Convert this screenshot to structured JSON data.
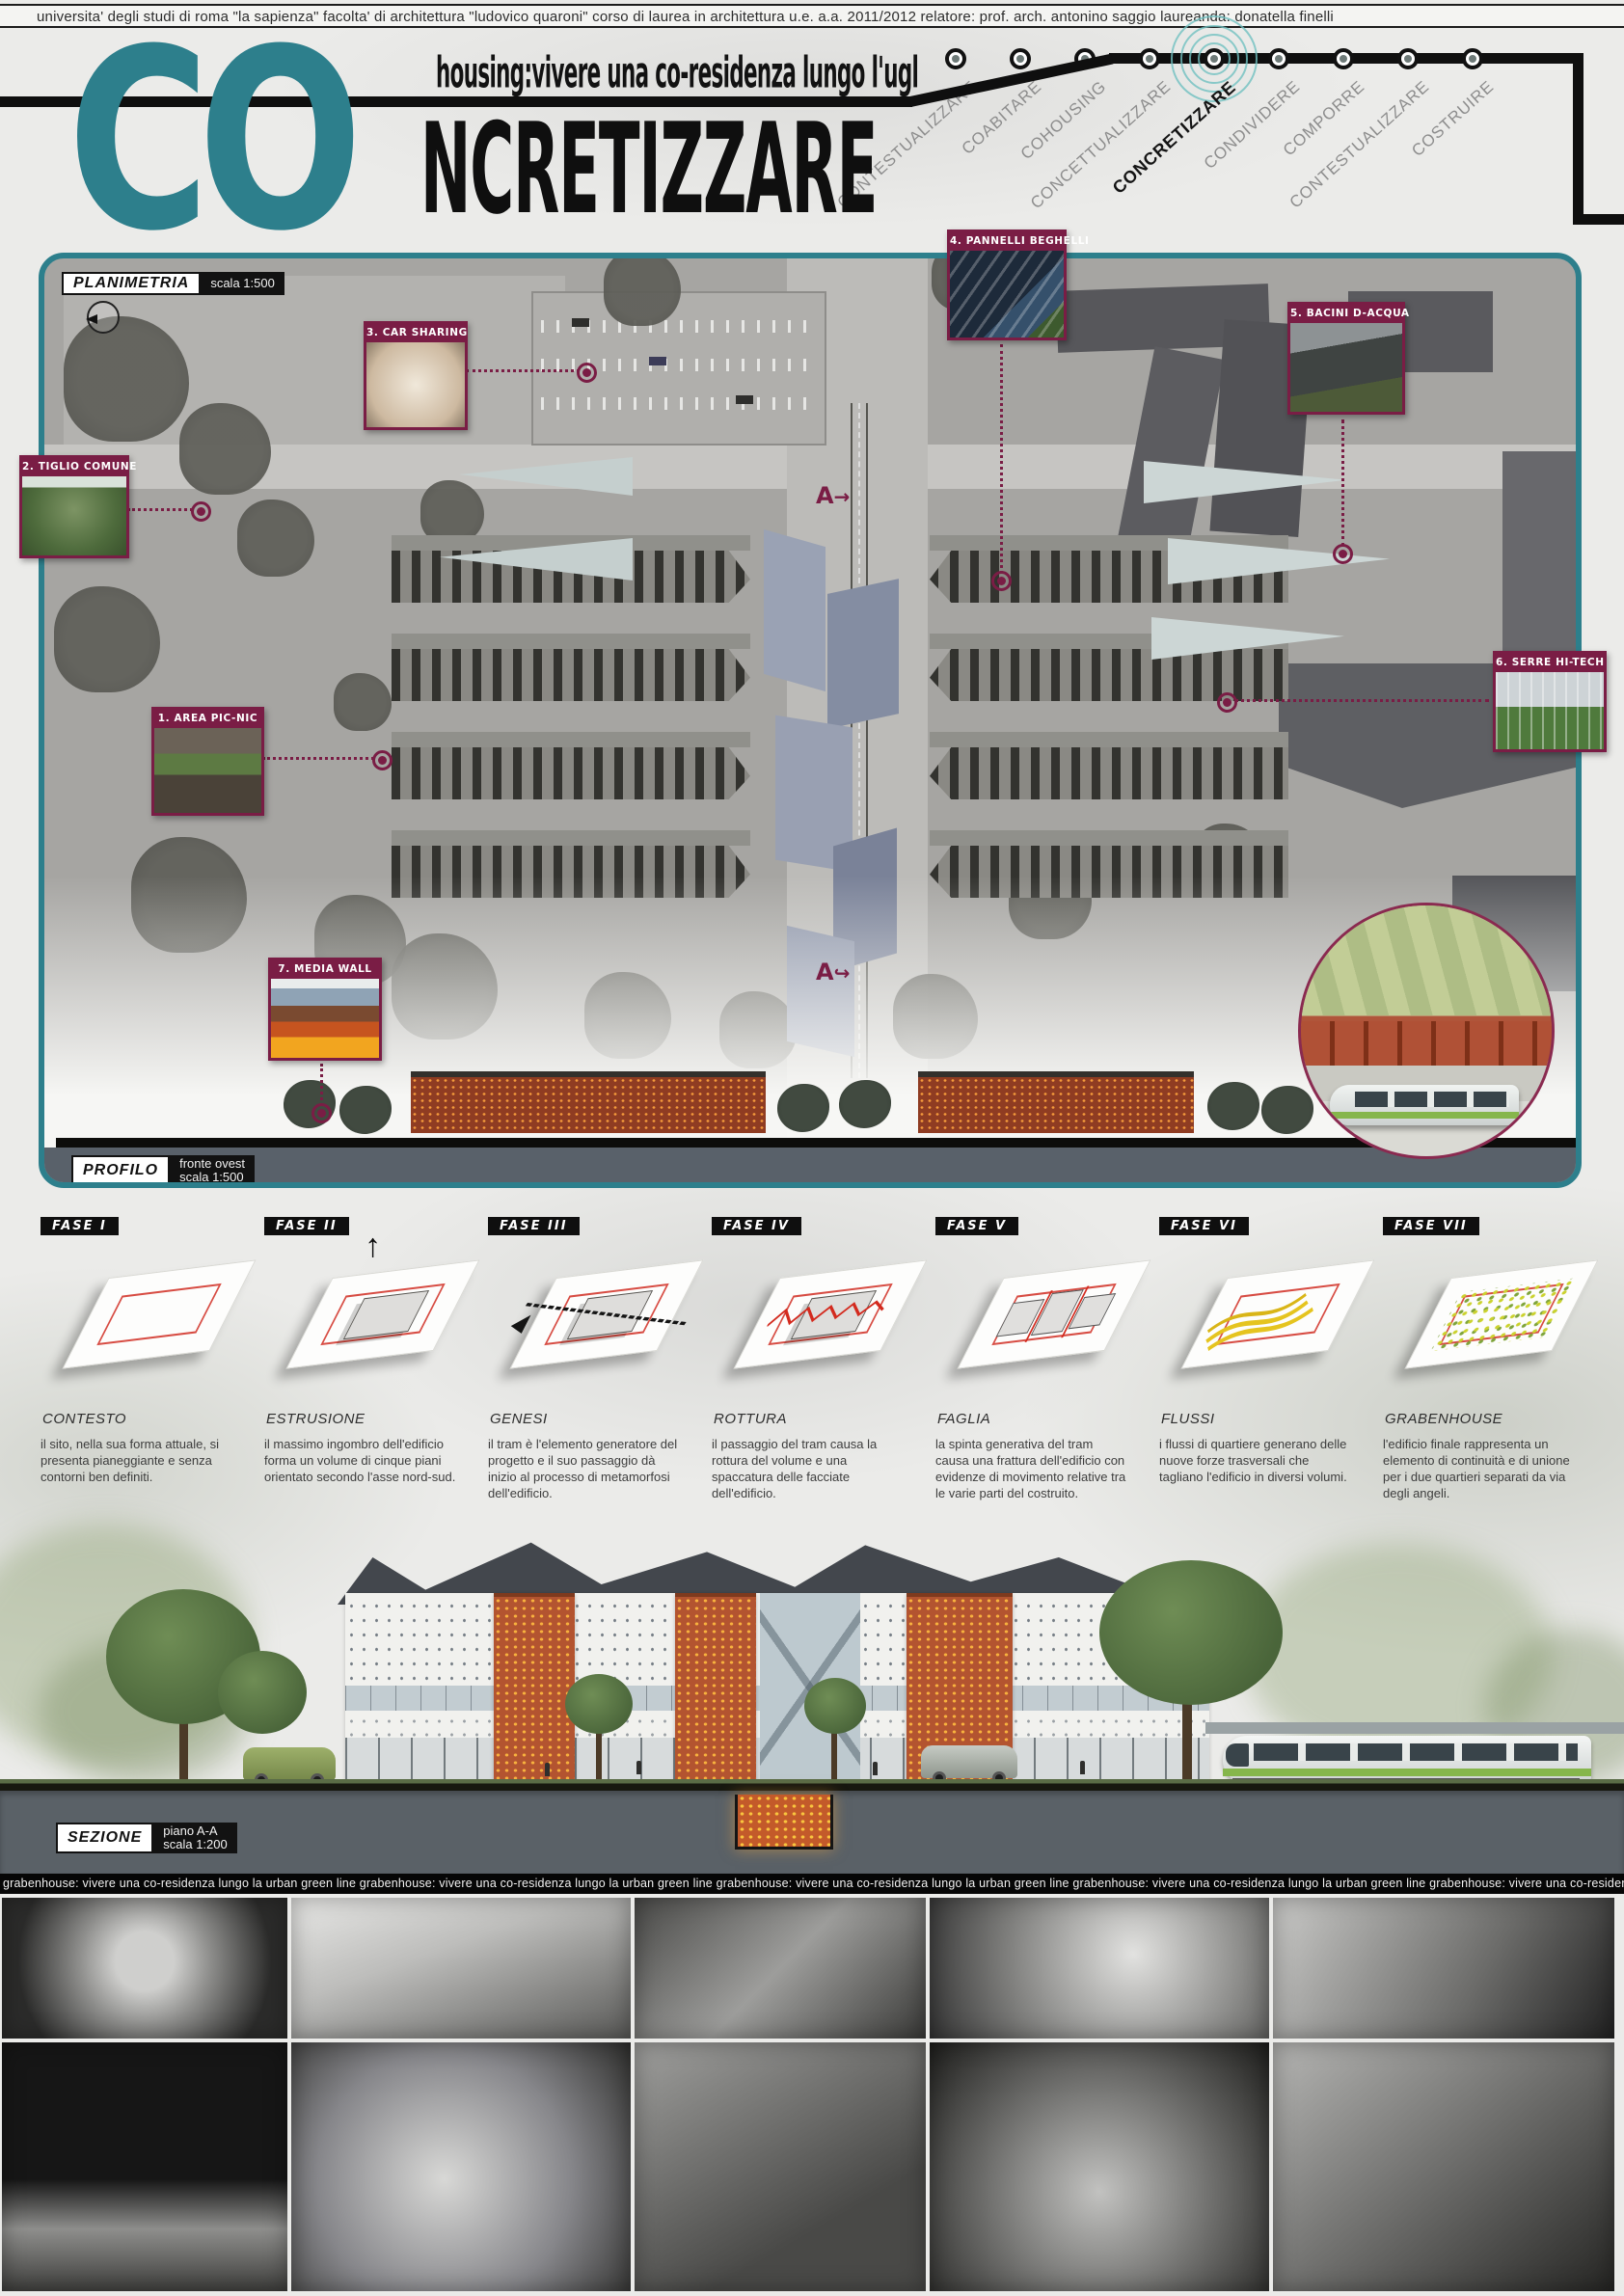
{
  "header": {
    "text": "universita' degli studi di roma \"la sapienza\"   facolta' di architettura \"ludovico quaroni\"   corso di laurea in architettura u.e.   a.a. 2011/2012   relatore: prof. arch. antonino saggio   laureanda: donatella finelli"
  },
  "title": {
    "co": "CO",
    "subtitle": "housing:vivere una co-residenza lungo l'ugl",
    "main_rest": "NCRETIZZARE"
  },
  "nav": {
    "items": [
      {
        "label": "CONTESTUALIZZARE",
        "active": false
      },
      {
        "label": "COABITARE",
        "active": false
      },
      {
        "label": "COHOUSING",
        "active": false
      },
      {
        "label": "CONCETTUALIZZARE",
        "active": false
      },
      {
        "label": "CONCRETIZZARE",
        "active": true
      },
      {
        "label": "CONDIVIDERE",
        "active": false
      },
      {
        "label": "COMPORRE",
        "active": false
      },
      {
        "label": "CONTESTUALIZZARE",
        "active": false
      },
      {
        "label": "COSTRUIRE",
        "active": false
      }
    ]
  },
  "plan": {
    "label": "PLANIMETRIA",
    "scale": "scala 1:500",
    "section_marker": "A",
    "callouts": [
      {
        "label": "1. AREA PIC-NIC"
      },
      {
        "label": "2. TIGLIO COMUNE"
      },
      {
        "label": "3. CAR SHARING"
      },
      {
        "label": "4. PANNELLI BEGHELLI"
      },
      {
        "label": "5. BACINI D-ACQUA"
      },
      {
        "label": "6. SERRE HI-TECH"
      },
      {
        "label": "7. MEDIA WALL"
      }
    ]
  },
  "profile": {
    "label": "PROFILO",
    "sub": "fronte ovest",
    "scale": "scala 1:500"
  },
  "phases": [
    {
      "fase": "FASE I",
      "title": "CONTESTO",
      "text": "il sito, nella sua forma attuale, si presenta pianeggiante e senza contorni ben definiti."
    },
    {
      "fase": "FASE II",
      "title": "ESTRUSIONE",
      "text": "il massimo ingombro dell'edificio forma un volume di cinque piani orientato secondo l'asse nord-sud."
    },
    {
      "fase": "FASE III",
      "title": "GENESI",
      "text": "il tram è l'elemento generatore del progetto e il suo passaggio dà inizio al processo di metamorfosi dell'edificio."
    },
    {
      "fase": "FASE IV",
      "title": "ROTTURA",
      "text": "il passaggio del tram causa la rottura del volume e una spaccatura delle facciate dell'edificio."
    },
    {
      "fase": "FASE V",
      "title": "FAGLIA",
      "text": "la spinta generativa del tram causa una frattura dell'edificio con evidenze di movimento relative tra le varie parti del costruito."
    },
    {
      "fase": "FASE VI",
      "title": "FLUSSI",
      "text": "i flussi di quartiere generano delle nuove forze trasversali che tagliano l'edificio in diversi volumi."
    },
    {
      "fase": "FASE VII",
      "title": "GRABENHOUSE",
      "text": "l'edificio finale rappresenta un elemento di continuità e di unione per i due quartieri separati da via degli angeli."
    }
  ],
  "section": {
    "label": "SEZIONE",
    "sub": "piano A-A",
    "scale": "scala 1:200"
  },
  "ticker": {
    "text": "grabenhouse: vivere una co-residenza lungo la urban green line grabenhouse: vivere una co-residenza lungo la urban green line grabenhouse: vivere una co-residenza lungo la urban green line grabenhouse: vivere una co-residenza lungo la urban green line grabenhouse: vivere una co-residenza lungo la urban green line"
  },
  "colors": {
    "accent_teal": "#2d7f8c",
    "maroon": "#7a1d45",
    "brick_orange": "#b35430",
    "band_gray": "#5a6167"
  }
}
